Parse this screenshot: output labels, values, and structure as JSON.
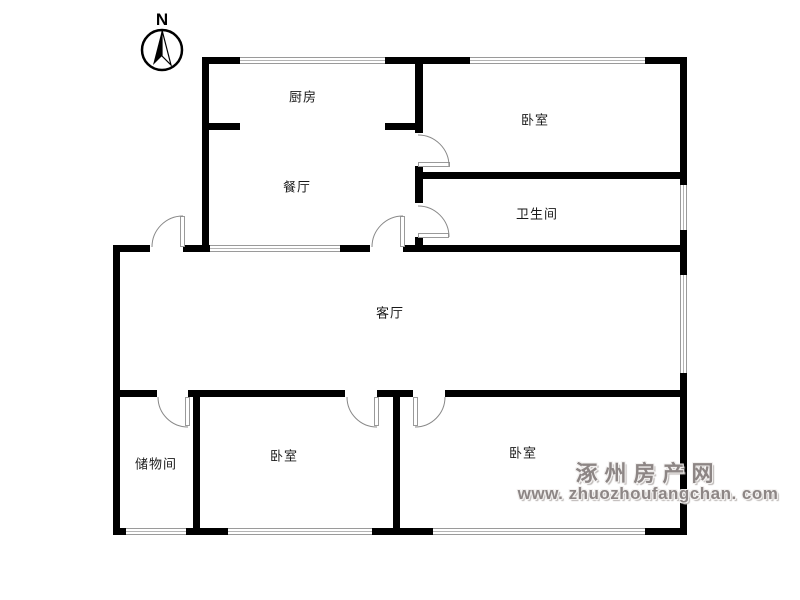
{
  "compass": {
    "north_label": "N"
  },
  "rooms": {
    "kitchen": {
      "label": "厨房"
    },
    "dining": {
      "label": "餐厅"
    },
    "bedroom_top": {
      "label": "卧室"
    },
    "bathroom": {
      "label": "卫生间"
    },
    "living": {
      "label": "客厅"
    },
    "storage": {
      "label": "储物间"
    },
    "bedroom_left": {
      "label": "卧室"
    },
    "bedroom_right": {
      "label": "卧室"
    }
  },
  "watermark": {
    "site_name": "涿州房产网",
    "site_url": "www. zhuozhoufangchan. com"
  },
  "colors": {
    "wall": "#000000",
    "window_line": "#9a9a9a",
    "door_arc": "#888888",
    "watermark_text": "#8d8685"
  }
}
